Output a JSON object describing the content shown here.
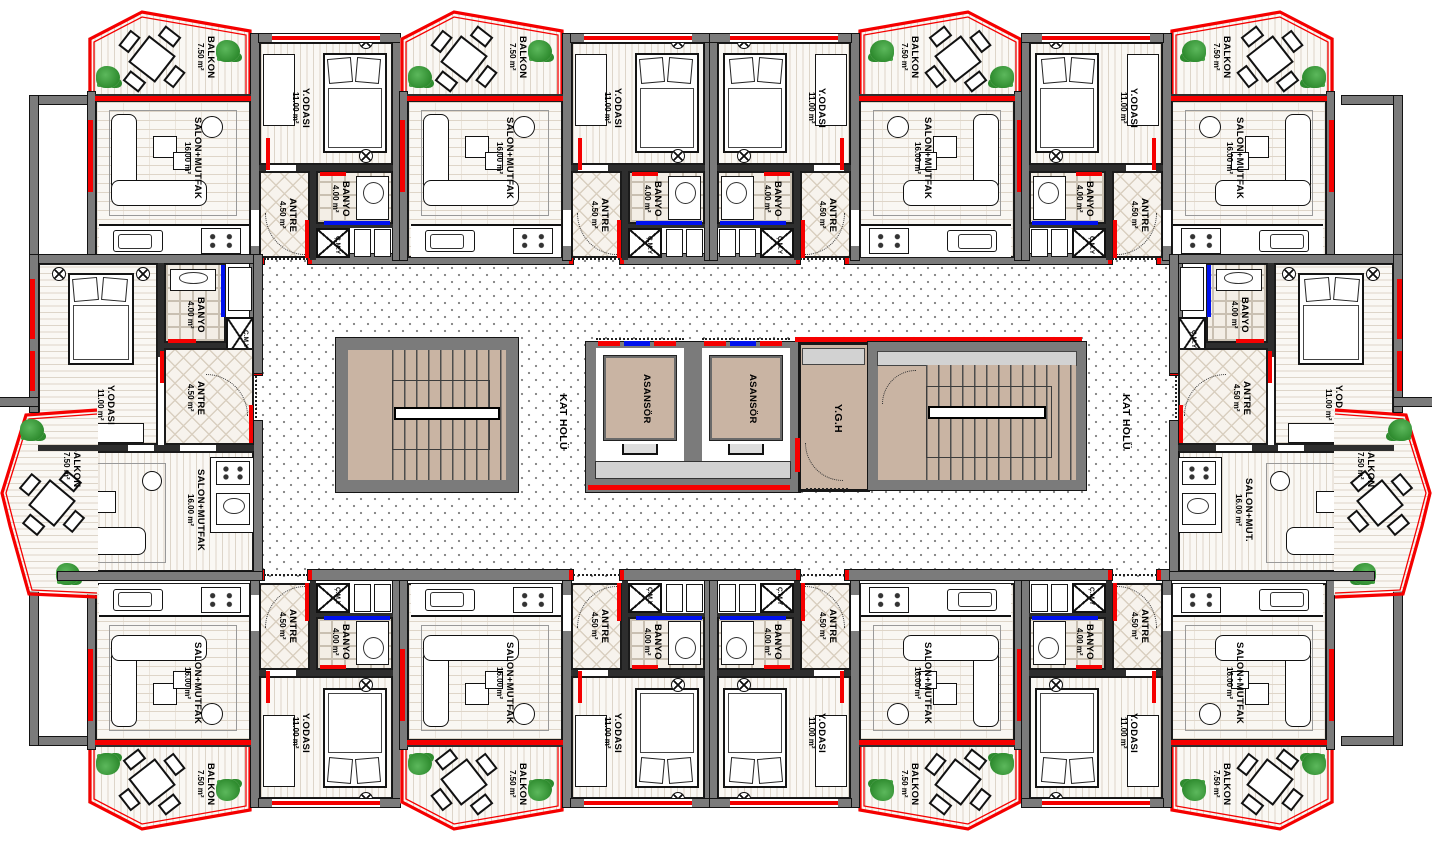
{
  "labels": {
    "balkon": {
      "name": "BALKON",
      "area": "7.50 m²"
    },
    "salon": {
      "name": "SALON+MUTFAK",
      "area": "16.00 m²"
    },
    "salon_abbrev": {
      "name": "SALON+MUT.",
      "area": "16.00 m²"
    },
    "yodasi": {
      "name": "Y.ODASI",
      "area": "11.00 m²"
    },
    "antre": {
      "name": "ANTRE",
      "area": "4.50 m²"
    },
    "banyo": {
      "name": "BANYO",
      "area": "4.00 m²"
    },
    "cmy": {
      "name": "Ç.M.Y"
    },
    "asansor": {
      "name": "ASANSÖR"
    },
    "ygh": {
      "name": "Y.G.H"
    },
    "kat_holu": {
      "name": "KAT HOLÜ"
    }
  },
  "colors": {
    "accent_red": "#f50000",
    "accent_blue": "#0011ee",
    "wall_gray": "#7b7b7b",
    "stair_floor_tan": "#c9b4a3",
    "landing_gray": "#d2d2d2",
    "plant_green": "#3aa03a"
  }
}
